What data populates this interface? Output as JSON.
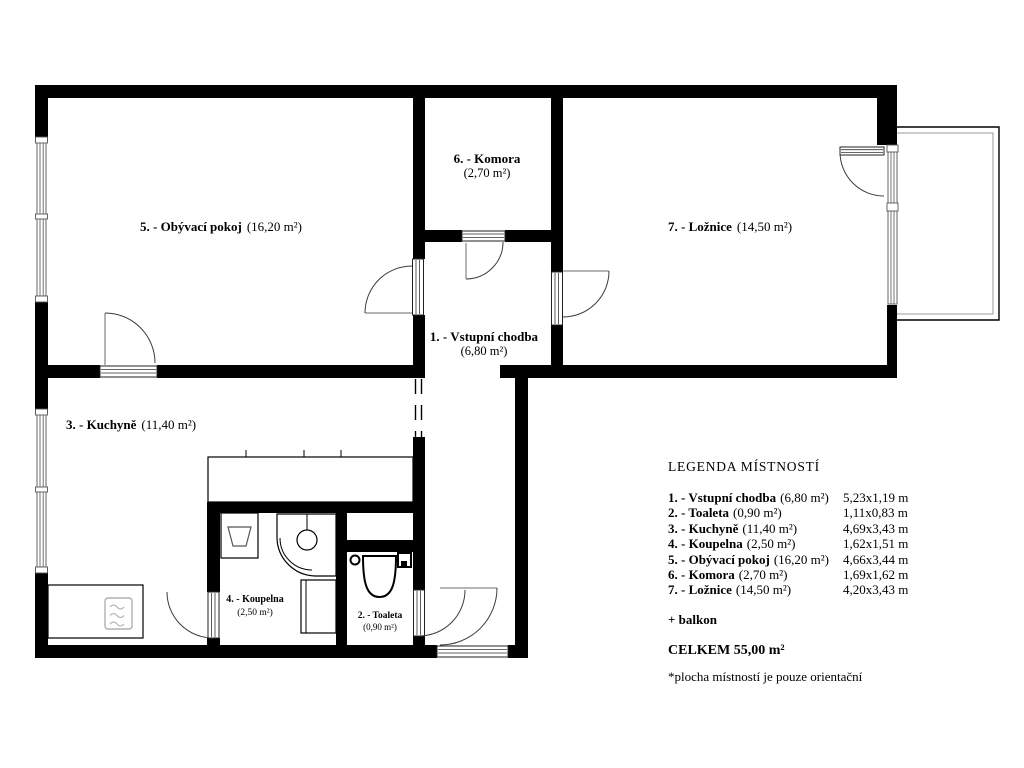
{
  "plan": {
    "living": {
      "name": "5. - Obývací pokoj",
      "area": "(16,20 m²)"
    },
    "komora": {
      "name": "6. - Komora",
      "area": "(2,70 m²)"
    },
    "loznice": {
      "name": "7. - Ložnice",
      "area": "(14,50 m²)"
    },
    "chodba": {
      "name": "1. - Vstupní chodba",
      "area": "(6,80 m²)"
    },
    "kuchyne": {
      "name": "3. - Kuchyně",
      "area": "(11,40 m²)"
    },
    "koupelna": {
      "name": "4. - Koupelna",
      "area": "(2,50 m²)"
    },
    "toaleta": {
      "name": "2. - Toaleta",
      "area": "(0,90 m²)"
    }
  },
  "legend": {
    "title": "LEGENDA MÍSTNOSTÍ",
    "rows": [
      {
        "label": "1. - Vstupní chodba",
        "area": "(6,80 m²)",
        "dim": "5,23x1,19 m"
      },
      {
        "label": "2. - Toaleta",
        "area": "(0,90 m²)",
        "dim": "1,11x0,83 m"
      },
      {
        "label": "3. - Kuchyně",
        "area": "(11,40 m²)",
        "dim": "4,69x3,43 m"
      },
      {
        "label": "4. - Koupelna",
        "area": "(2,50 m²)",
        "dim": "1,62x1,51 m"
      },
      {
        "label": "5. - Obývací pokoj",
        "area": "(16,20 m²)",
        "dim": "4,66x3,44 m"
      },
      {
        "label": "6. - Komora",
        "area": "(2,70 m²)",
        "dim": "1,69x1,62 m"
      },
      {
        "label": "7. - Ložnice",
        "area": "(14,50 m²)",
        "dim": "4,20x3,43 m"
      }
    ],
    "balcony_note": "+ balkon",
    "total": "CELKEM 55,00 m²",
    "footnote": "*plocha místností je pouze orientační"
  },
  "colors": {
    "wall": "#000000",
    "background": "#ffffff",
    "window_line": "#666666",
    "appliance": "#b0b0b0",
    "door_arc": "#3c3c3c"
  }
}
